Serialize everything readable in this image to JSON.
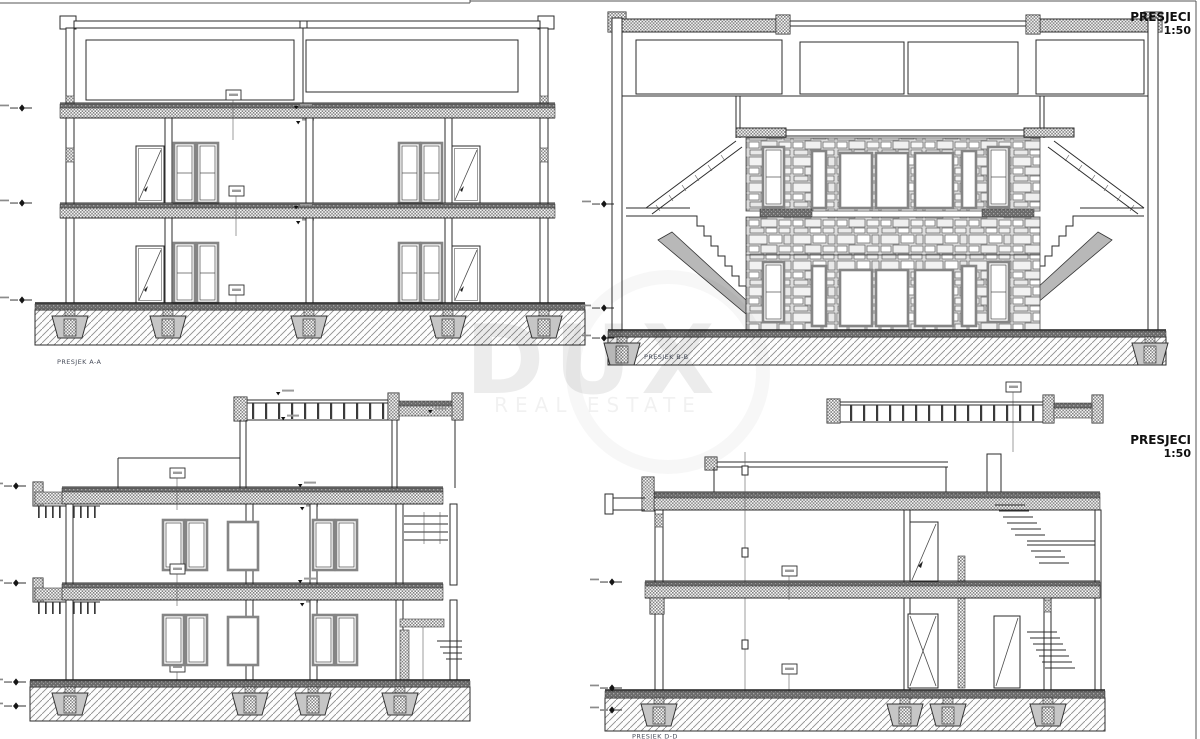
{
  "sheet": {
    "title_blocks": [
      {
        "label": "PRESJECI",
        "scale": "1:50"
      },
      {
        "label": "PRESJECI",
        "scale": "1:50"
      }
    ]
  },
  "sections": {
    "a": {
      "label": "PRESJEK A-A"
    },
    "b": {
      "label": "PRESJEK B-B"
    },
    "d": {
      "label": "PRESJEK D-D"
    }
  },
  "watermark": {
    "brand": "DUX",
    "tagline": "REAL ESTATE"
  },
  "colors": {
    "line": "#2b2b2b",
    "hatch_gray": "#8e8e8e",
    "band_dark": "#6b6b6b",
    "label": "#4a4f5c"
  }
}
